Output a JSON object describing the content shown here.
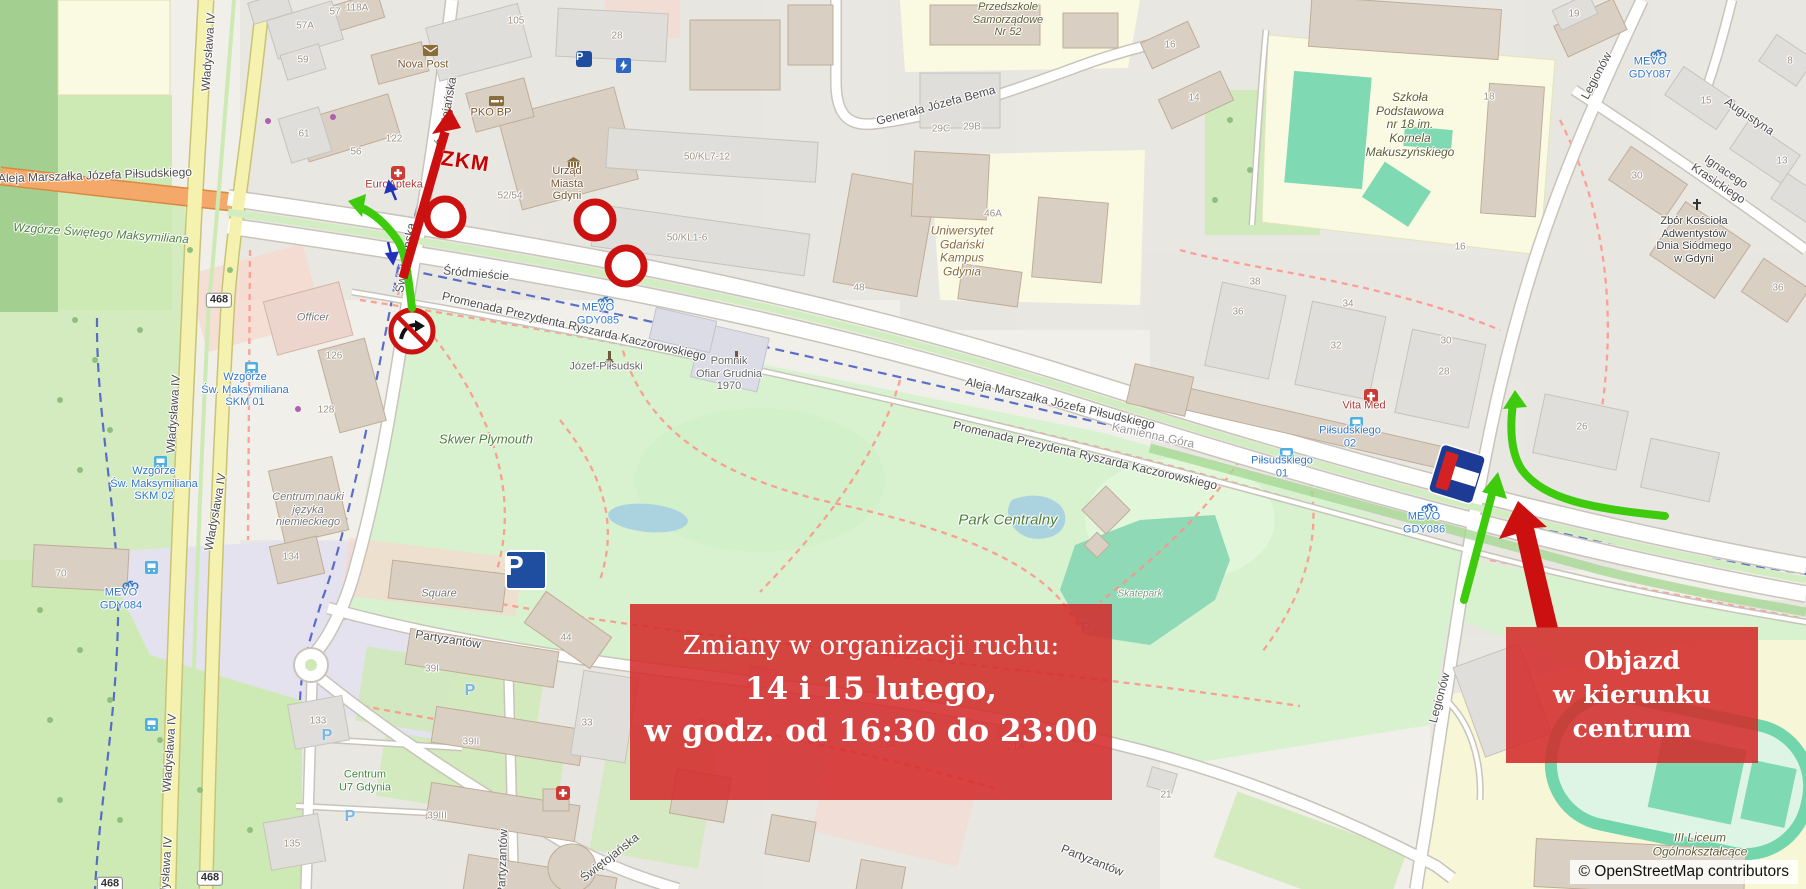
{
  "annotations": {
    "main_box": {
      "line1": "Zmiany w organizacji ruchu:",
      "line2": "14 i 15 lutego,",
      "line3": "w godz. od 16:30 do 23:00"
    },
    "detour_box": {
      "line1": "Objazd",
      "line2": "w kierunku centrum"
    },
    "zkm_label": "ZKM",
    "colors": {
      "box_red": "#d32a2a",
      "arrow_green": "#3ecb0e",
      "arrow_red": "#cc1111",
      "sign_navy": "#1d3b94"
    }
  },
  "attribution": "© OpenStreetMap contributors",
  "map": {
    "labels": [
      {
        "t": "Aleja Marszałka Józefa Piłsudskiego",
        "x": 95,
        "y": 176,
        "r": -2,
        "c": "st"
      },
      {
        "t": "Władysława IV",
        "x": 209,
        "y": 52,
        "r": -86,
        "c": "st"
      },
      {
        "t": "Władysława IV",
        "x": 174,
        "y": 414,
        "r": -86,
        "c": "st"
      },
      {
        "t": "Władysława IV",
        "x": 216,
        "y": 512,
        "r": -80,
        "c": "st"
      },
      {
        "t": "Władysława IV",
        "x": 170,
        "y": 753,
        "r": -86,
        "c": "st"
      },
      {
        "t": "Władysława IV",
        "x": 166,
        "y": 876,
        "r": -86,
        "c": "st"
      },
      {
        "t": "Świętojańska",
        "x": 447,
        "y": 112,
        "r": -80,
        "c": "st"
      },
      {
        "t": "Świętojańska",
        "x": 406,
        "y": 258,
        "r": -80,
        "c": "st"
      },
      {
        "t": "Świętojańska",
        "x": 610,
        "y": 858,
        "r": -38,
        "c": "st"
      },
      {
        "t": "Partyzantów",
        "x": 448,
        "y": 640,
        "r": 9,
        "c": "st"
      },
      {
        "t": "Partyzantów",
        "x": 503,
        "y": 862,
        "r": -88,
        "c": "st"
      },
      {
        "t": "Partyzantów",
        "x": 1092,
        "y": 861,
        "r": 22,
        "c": "st"
      },
      {
        "t": "Legionów",
        "x": 1597,
        "y": 76,
        "r": -62,
        "c": "st"
      },
      {
        "t": "Legionów",
        "x": 1440,
        "y": 698,
        "r": -75,
        "c": "st"
      },
      {
        "t": "Generała Józefa Bema",
        "x": 936,
        "y": 106,
        "r": -15,
        "c": "st"
      },
      {
        "t": "Augustyna",
        "x": 1749,
        "y": 117,
        "r": 34,
        "c": "st"
      },
      {
        "t": "Ignacego Krasickiego",
        "x": 1722,
        "y": 178,
        "r": 34,
        "c": "st"
      },
      {
        "t": "Aleja Marszałka Józefa Piłsudskiego",
        "x": 1060,
        "y": 404,
        "r": 13,
        "c": "st"
      },
      {
        "t": "Aleja Marszałka Józefa Piłsudskiego",
        "x": 1860,
        "y": 573,
        "r": 13,
        "c": "st"
      },
      {
        "t": "Promenada Prezydenta Ryszarda Kaczorowskiego",
        "x": 574,
        "y": 327,
        "r": 13,
        "c": "st"
      },
      {
        "t": "Promenada Prezydenta Ryszarda Kaczorowskiego",
        "x": 1085,
        "y": 456,
        "r": 13,
        "c": "st"
      },
      {
        "t": "Promenada Prezydenta Ryszarda Kaczorowskiego",
        "x": 1870,
        "y": 652,
        "r": 16,
        "c": "st"
      },
      {
        "t": "Śródmieście",
        "x": 476,
        "y": 274,
        "r": 5,
        "c": "st"
      },
      {
        "t": "Kamienna Góra",
        "x": 1153,
        "y": 436,
        "r": 12,
        "c": "stl"
      },
      {
        "t": "Skwer Plymouth",
        "x": 486,
        "y": 440,
        "r": 0,
        "c": "grn",
        "s": 13
      },
      {
        "t": "Park Centralny",
        "x": 1008,
        "y": 520,
        "r": 0,
        "c": "grn",
        "s": 15
      },
      {
        "t": "Skatepark",
        "x": 1140,
        "y": 594,
        "r": 0,
        "c": "skp",
        "s": 10
      },
      {
        "t": "Wzgórze Świętego Maksymiliana",
        "x": 101,
        "y": 234,
        "r": 4,
        "c": "grn"
      },
      {
        "t": "Nova Post",
        "x": 423,
        "y": 65,
        "r": 0,
        "c": "poi",
        "s": 11
      },
      {
        "t": "PKO BP",
        "x": 491,
        "y": 113,
        "r": 0,
        "c": "poi",
        "s": 11
      },
      {
        "t": "EuroApteka",
        "x": 394,
        "y": 185,
        "r": 0,
        "c": "med",
        "s": 11
      },
      {
        "t": "Urząd\nMiasta\nGdyni",
        "x": 567,
        "y": 184,
        "r": 0,
        "c": "poi",
        "s": 11
      },
      {
        "t": "Uniwersytet\nGdański\nKampus\nGdynia",
        "x": 962,
        "y": 252,
        "r": 0,
        "c": "poib",
        "s": 12
      },
      {
        "t": "Szkoła\nPodstawowa\nnr 18 im.\nKornela\nMakuszyńskiego",
        "x": 1410,
        "y": 125,
        "r": 0,
        "c": "sch",
        "s": 12
      },
      {
        "t": "Przedszkole\nSamorządowe\nNr 52",
        "x": 1008,
        "y": 20,
        "r": 0,
        "c": "sch",
        "s": 11
      },
      {
        "t": "Zbór Kościoła\nAdwentystów\nDnia Siódmego\nw Gdyni",
        "x": 1694,
        "y": 240,
        "r": 0,
        "c": "dark",
        "s": 11
      },
      {
        "t": "Pomnik\nOfiar Grudnia\n1970",
        "x": 729,
        "y": 374,
        "r": 0,
        "c": "stl2",
        "s": 11
      },
      {
        "t": "Józef-Piłsudski",
        "x": 606,
        "y": 367,
        "r": 0,
        "c": "stl2",
        "s": 11
      },
      {
        "t": "III Liceum\nOgólnokształcące",
        "x": 1700,
        "y": 845,
        "r": 0,
        "c": "sch",
        "s": 12
      },
      {
        "t": "Officer",
        "x": 313,
        "y": 318,
        "r": 0,
        "c": "name",
        "s": 11
      },
      {
        "t": "Centrum nauki\njęzyka\nniemieckiego",
        "x": 308,
        "y": 510,
        "r": 0,
        "c": "name",
        "s": 11
      },
      {
        "t": "Square",
        "x": 439,
        "y": 594,
        "r": 0,
        "c": "name",
        "s": 11
      },
      {
        "t": "Centrum\nU7 Gdynia",
        "x": 365,
        "y": 781,
        "r": 0,
        "c": "grn2",
        "s": 11
      },
      {
        "t": "Vita Med",
        "x": 1364,
        "y": 406,
        "r": 0,
        "c": "med",
        "s": 11
      },
      {
        "t": "MEVO\nGDY085",
        "x": 598,
        "y": 314,
        "r": 0,
        "c": "blu",
        "s": 11
      },
      {
        "t": "MEVO\nGDY084",
        "x": 121,
        "y": 599,
        "r": 0,
        "c": "blu",
        "s": 11
      },
      {
        "t": "MEVO\nGDY086",
        "x": 1424,
        "y": 523,
        "r": 0,
        "c": "blu",
        "s": 11
      },
      {
        "t": "MEVO\nGDY087",
        "x": 1650,
        "y": 68,
        "r": 0,
        "c": "blu",
        "s": 11
      },
      {
        "t": "Wzgórze\nŚw. Maksymiliana\nSKM 01",
        "x": 245,
        "y": 390,
        "r": 0,
        "c": "blu",
        "s": 11
      },
      {
        "t": "Wzgórze\nŚw. Maksymiliana\nSKM 02",
        "x": 154,
        "y": 484,
        "r": 0,
        "c": "blu",
        "s": 11
      },
      {
        "t": "Piłsudskiego\n01",
        "x": 1282,
        "y": 467,
        "r": 0,
        "c": "blu",
        "s": 11
      },
      {
        "t": "Piłsudskiego\n02",
        "x": 1350,
        "y": 437,
        "r": 0,
        "c": "blu",
        "s": 11
      },
      {
        "t": "118A",
        "x": 357,
        "y": 8,
        "c": "num"
      },
      {
        "t": "105",
        "x": 516,
        "y": 21,
        "c": "num"
      },
      {
        "t": "28",
        "x": 617,
        "y": 36,
        "c": "num"
      },
      {
        "t": "57",
        "x": 335,
        "y": 12,
        "c": "num"
      },
      {
        "t": "57A",
        "x": 305,
        "y": 26,
        "c": "num"
      },
      {
        "t": "59",
        "x": 303,
        "y": 60,
        "c": "num"
      },
      {
        "t": "61",
        "x": 304,
        "y": 134,
        "c": "num"
      },
      {
        "t": "122",
        "x": 394,
        "y": 139,
        "c": "num"
      },
      {
        "t": "56",
        "x": 356,
        "y": 152,
        "c": "num"
      },
      {
        "t": "52/54",
        "x": 510,
        "y": 196,
        "c": "num"
      },
      {
        "t": "50/KL7-12",
        "x": 707,
        "y": 157,
        "c": "num"
      },
      {
        "t": "50/KL1-6",
        "x": 687,
        "y": 238,
        "c": "num"
      },
      {
        "t": "29B",
        "x": 972,
        "y": 127,
        "c": "num"
      },
      {
        "t": "29C",
        "x": 941,
        "y": 129,
        "c": "num"
      },
      {
        "t": "46A",
        "x": 993,
        "y": 214,
        "c": "num"
      },
      {
        "t": "48",
        "x": 859,
        "y": 288,
        "c": "num"
      },
      {
        "t": "16",
        "x": 1170,
        "y": 45,
        "c": "num"
      },
      {
        "t": "14",
        "x": 1194,
        "y": 98,
        "c": "num"
      },
      {
        "t": "18",
        "x": 1489,
        "y": 97,
        "c": "num"
      },
      {
        "t": "16",
        "x": 1460,
        "y": 247,
        "c": "num"
      },
      {
        "t": "19",
        "x": 1574,
        "y": 14,
        "c": "num"
      },
      {
        "t": "8",
        "x": 1790,
        "y": 61,
        "c": "num"
      },
      {
        "t": "15",
        "x": 1706,
        "y": 101,
        "c": "num"
      },
      {
        "t": "13",
        "x": 1782,
        "y": 161,
        "c": "num"
      },
      {
        "t": "30",
        "x": 1637,
        "y": 176,
        "c": "num"
      },
      {
        "t": "36",
        "x": 1778,
        "y": 288,
        "c": "num"
      },
      {
        "t": "38",
        "x": 1255,
        "y": 282,
        "c": "num"
      },
      {
        "t": "36",
        "x": 1238,
        "y": 312,
        "c": "num"
      },
      {
        "t": "34",
        "x": 1348,
        "y": 304,
        "c": "num"
      },
      {
        "t": "32",
        "x": 1336,
        "y": 346,
        "c": "num"
      },
      {
        "t": "30",
        "x": 1446,
        "y": 341,
        "c": "num"
      },
      {
        "t": "28",
        "x": 1444,
        "y": 372,
        "c": "num"
      },
      {
        "t": "26",
        "x": 1582,
        "y": 427,
        "c": "num"
      },
      {
        "t": "70",
        "x": 61,
        "y": 574,
        "c": "num"
      },
      {
        "t": "126",
        "x": 334,
        "y": 356,
        "c": "num"
      },
      {
        "t": "128",
        "x": 326,
        "y": 410,
        "c": "num"
      },
      {
        "t": "134",
        "x": 291,
        "y": 557,
        "c": "num"
      },
      {
        "t": "133",
        "x": 318,
        "y": 721,
        "c": "num"
      },
      {
        "t": "135",
        "x": 292,
        "y": 844,
        "c": "num"
      },
      {
        "t": "44",
        "x": 566,
        "y": 638,
        "c": "num"
      },
      {
        "t": "33",
        "x": 587,
        "y": 723,
        "c": "num"
      },
      {
        "t": "39I",
        "x": 432,
        "y": 669,
        "c": "num"
      },
      {
        "t": "39II",
        "x": 471,
        "y": 742,
        "c": "num"
      },
      {
        "t": "39III",
        "x": 437,
        "y": 816,
        "c": "num"
      },
      {
        "t": "27A",
        "x": 766,
        "y": 691,
        "c": "num"
      },
      {
        "t": "23A",
        "x": 887,
        "y": 745,
        "c": "num"
      },
      {
        "t": "21A",
        "x": 1016,
        "y": 747,
        "c": "num"
      },
      {
        "t": "21",
        "x": 1166,
        "y": 795,
        "c": "num"
      },
      {
        "t": "468",
        "x": 219,
        "y": 300,
        "c": "shield"
      },
      {
        "t": "468",
        "x": 210,
        "y": 878,
        "c": "shield"
      },
      {
        "t": "468",
        "x": 110,
        "y": 884,
        "c": "shield"
      }
    ],
    "icons": [
      {
        "k": "bike",
        "x": 597,
        "y": 294
      },
      {
        "k": "bike",
        "x": 122,
        "y": 578
      },
      {
        "k": "bike",
        "x": 1421,
        "y": 501
      },
      {
        "k": "bike",
        "x": 1650,
        "y": 47
      },
      {
        "k": "bus",
        "x": 245,
        "y": 362
      },
      {
        "k": "bus",
        "x": 154,
        "y": 456
      },
      {
        "k": "bus",
        "x": 1280,
        "y": 448
      },
      {
        "k": "bus",
        "x": 1350,
        "y": 417
      },
      {
        "k": "bus",
        "x": 145,
        "y": 561
      },
      {
        "k": "bus",
        "x": 145,
        "y": 718
      },
      {
        "k": "medical",
        "x": 391,
        "y": 166
      },
      {
        "k": "medical",
        "x": 1364,
        "y": 389
      },
      {
        "k": "medical",
        "x": 556,
        "y": 786
      },
      {
        "k": "mail",
        "x": 423,
        "y": 45
      },
      {
        "k": "card",
        "x": 489,
        "y": 96
      },
      {
        "k": "townhall",
        "x": 566,
        "y": 157
      },
      {
        "k": "church",
        "x": 1691,
        "y": 198
      },
      {
        "k": "monument",
        "x": 605,
        "y": 350
      },
      {
        "k": "monument",
        "x": 732,
        "y": 350
      },
      {
        "k": "parking-navy-big",
        "x": 526,
        "y": 570
      },
      {
        "k": "parking-navy-small",
        "x": 584,
        "y": 59
      },
      {
        "k": "parking-blue",
        "x": 470,
        "y": 691
      },
      {
        "k": "parking-blue",
        "x": 1086,
        "y": 629
      },
      {
        "k": "parking-blue",
        "x": 350,
        "y": 817
      },
      {
        "k": "parking-blue",
        "x": 327,
        "y": 736
      },
      {
        "k": "ev-charger",
        "x": 616,
        "y": 58
      }
    ]
  }
}
